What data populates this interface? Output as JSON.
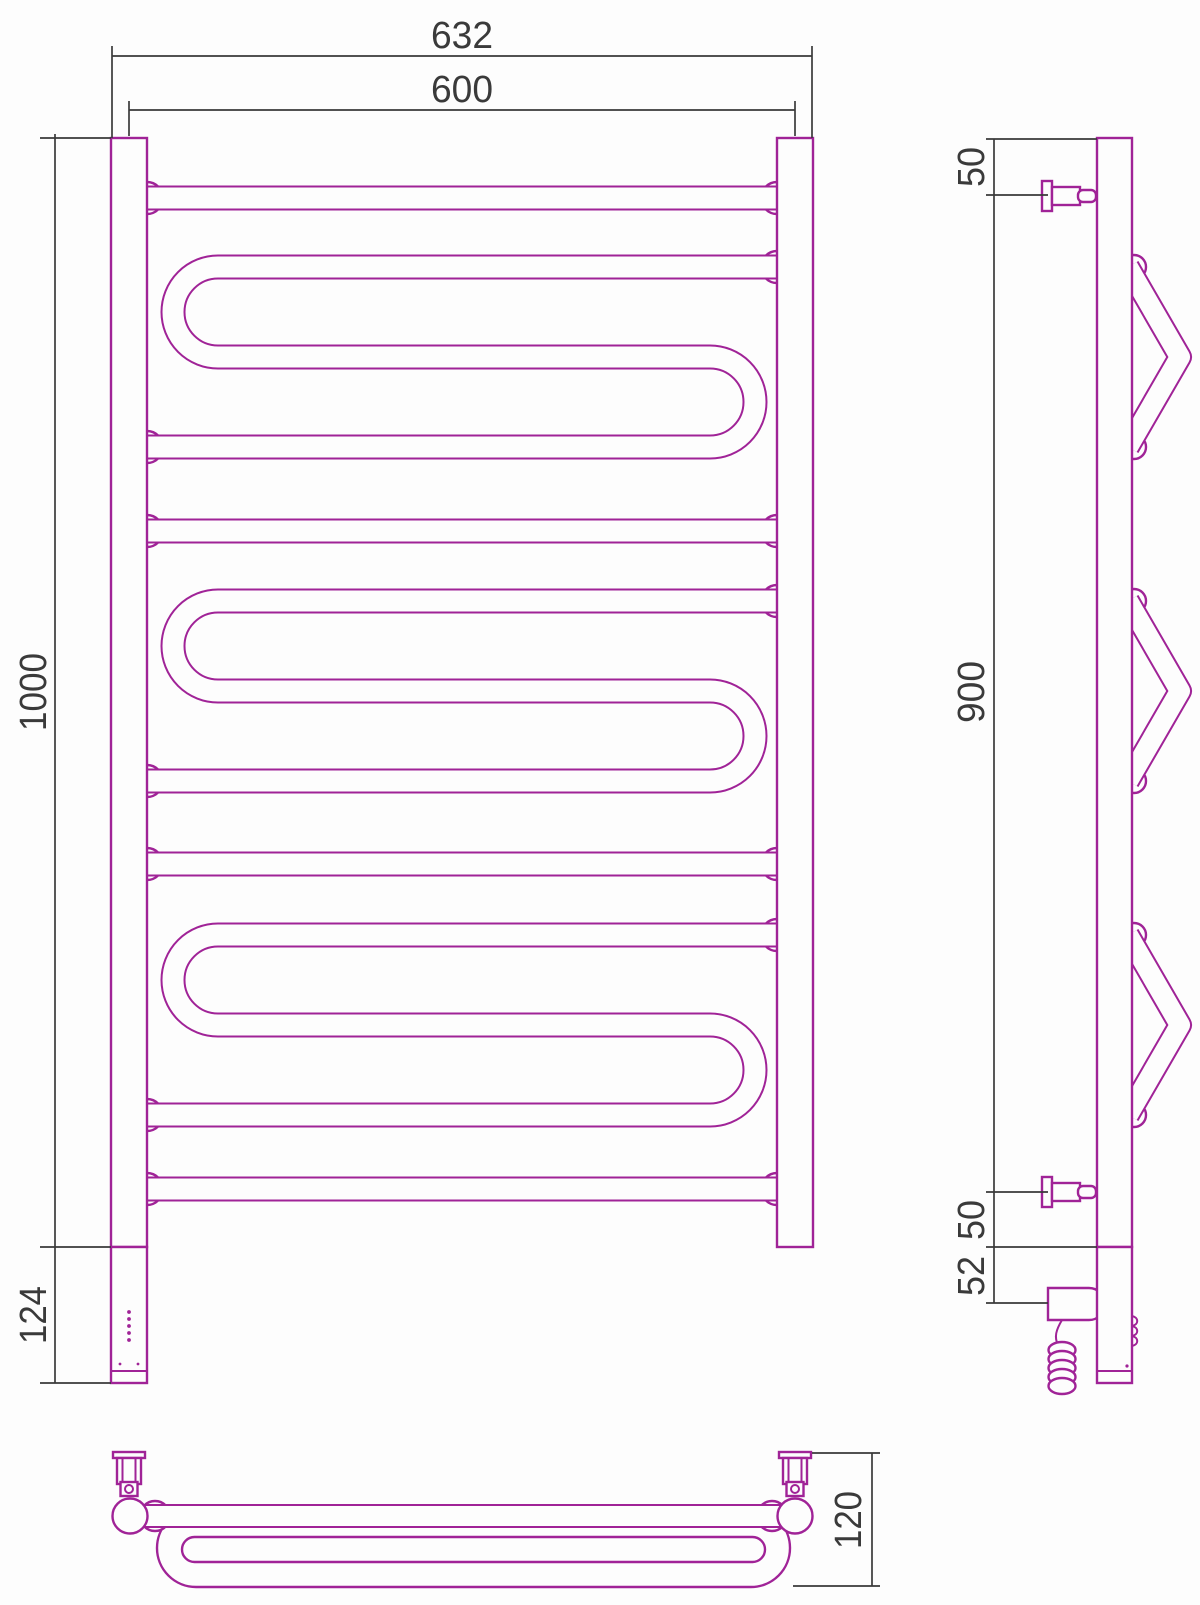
{
  "drawing_type": "towel-rail-technical-drawing",
  "views": {
    "front": {
      "width_overall": "632",
      "width_between_centers": "600",
      "body_height": "1000",
      "heater_section_height": "124"
    },
    "side": {
      "top_bracket_offset": "50",
      "bracket_span": "900",
      "bottom_bracket_offset": "50",
      "heater_unit_offset": "52"
    },
    "top": {
      "depth": "120"
    }
  },
  "colors": {
    "product_line": "#a02397",
    "dimension_line": "#3a3a3a",
    "background": "#fdfdfd"
  }
}
